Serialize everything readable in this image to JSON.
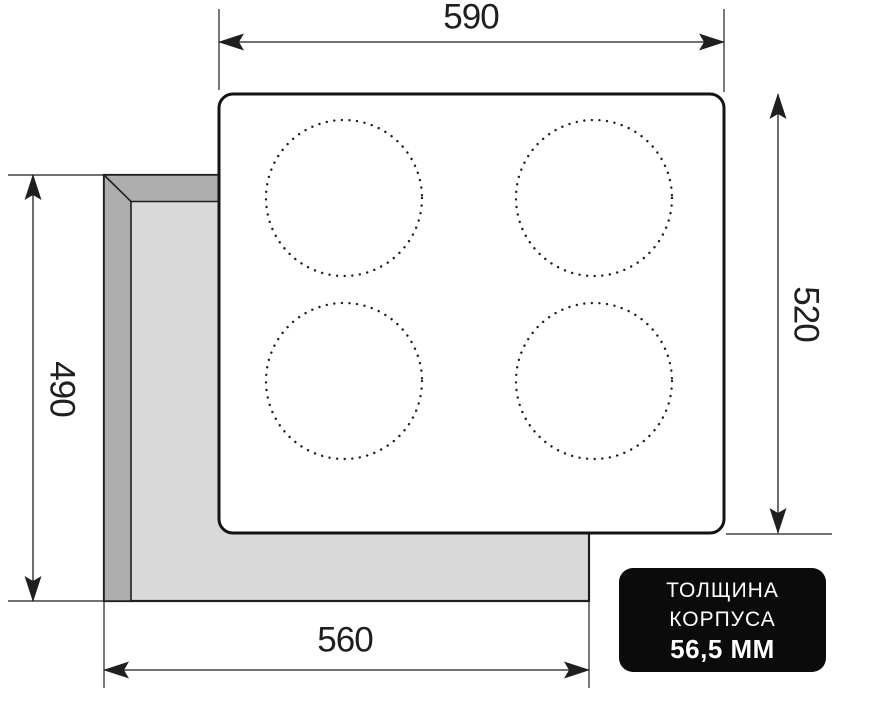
{
  "dimensions": {
    "width_top": "590",
    "height_right": "520",
    "height_left": "490",
    "width_bottom": "560"
  },
  "badge": {
    "line1": "ТОЛЩИНА",
    "line2": "КОРПУСА",
    "line3": "56,5 ММ"
  },
  "burner_count": 4,
  "colors": {
    "line": "#1f1f1f",
    "panel_outline": "#141414",
    "panel_fill": "#ffffff",
    "cutout_light": "#d9d9d9",
    "cutout_dark": "#adadad",
    "badge_bg": "#0b0b0b",
    "badge_text": "#ffffff",
    "background": "#ffffff",
    "dot": "#1c1c1c"
  }
}
